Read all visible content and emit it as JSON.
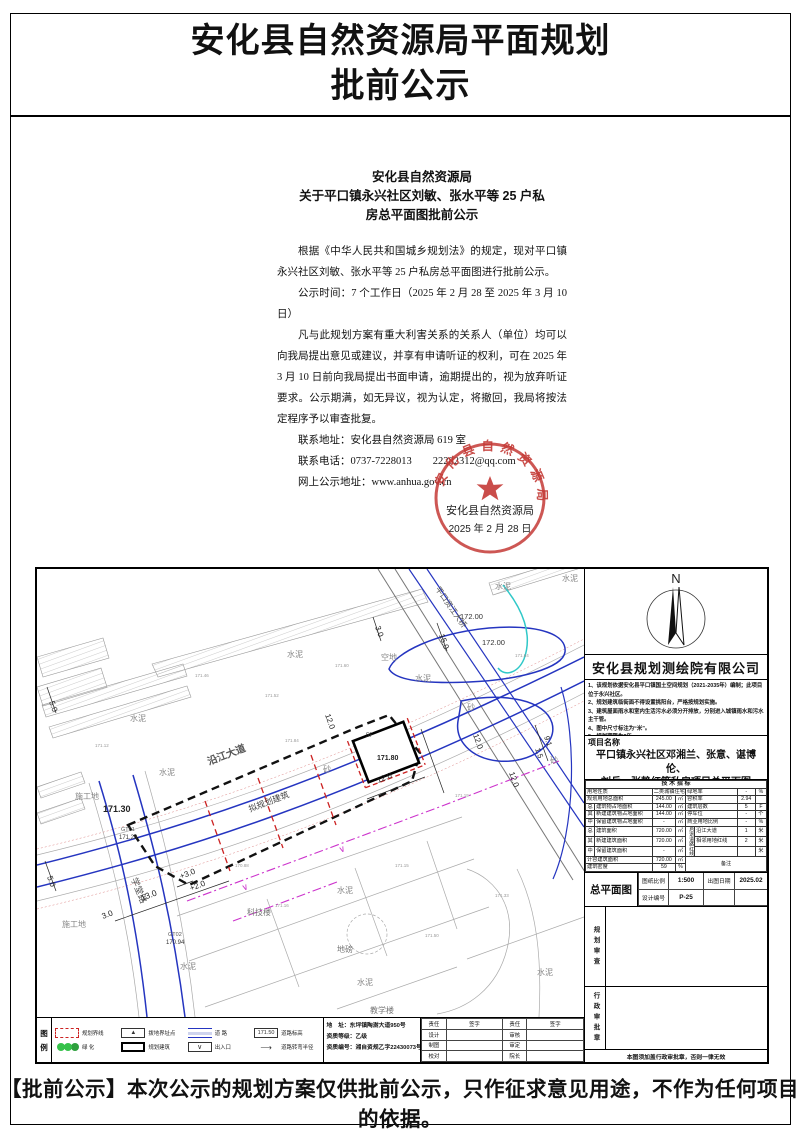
{
  "page": {
    "title1": "安化县自然资源局平面规划",
    "title2": "批前公示",
    "footer": "【批前公示】本次公示的规划方案仅供批前公示，只作征求意见用途，不作为任何项目的依据。"
  },
  "notice": {
    "h1": "安化县自然资源局",
    "h2": "关于平口镇永兴社区刘敏、张水平等 25 户私",
    "h3": "房总平面图批前公示",
    "p1": "根据《中华人民共和国城乡规划法》的规定，现对平口镇永兴社区刘敏、张水平等 25 户私房总平面图进行批前公示。",
    "p2": "公示时间：7 个工作日（2025 年 2 月 28 至 2025 年 3 月 10 日）",
    "p3": "凡与此规划方案有重大利害关系的关系人（单位）均可以向我局提出意见或建议，并享有申请听证的权利，可在 2025 年 3 月 10 日前向我局提出书面申请，逾期提出的，视为放弃听证要求。公示期满，如无异议，视为认定，将撤回，我局将按法定程序予以审查批复。",
    "addr": "联系地址：安化县自然资源局 619 室",
    "phone": "联系电话：0737-7228013　　22282312@qq.com",
    "web": "网上公示地址：www.anhua.gov.cn",
    "seal": {
      "ring": "安化县自然资源局",
      "org": "安化县自然资源局",
      "date": "2025 年 2 月 28 日",
      "color": "#c43a36"
    }
  },
  "panel": {
    "north": "N",
    "company": "安化县规划测绘院有限公司",
    "notes": [
      "1、该规划依据安化县平口镇国土空间规划（2021-2035年）编制；此项目位于永兴社区。",
      "2、规划建筑临街面不得设置挑阳台，严格按规划实施。",
      "3、建筑屋面雨水和室内生活污水必须分开排放，分别进入城镇雨水和污水主干管。",
      "4、图中尺寸标注为“米”。",
      "5、规划期限为2年。"
    ],
    "project_label": "项目名称",
    "project1": "平口镇永兴社区邓湘兰、张意、谌博伦、",
    "project2": "刘兵、张静红等私房项目总平面图",
    "tech": {
      "rows": [
        [
          {
            "t": "技 术 指 标",
            "cs": 8,
            "cl": "hd"
          }
        ],
        [
          {
            "t": "用地性质",
            "cs": 2,
            "cl": "lb"
          },
          {
            "t": "二类城镇住宅用地",
            "cs": 2,
            "cl": "ct"
          },
          {
            "t": "绿地率",
            "cs": 2,
            "cl": "lb"
          },
          {
            "t": "-",
            "cl": "ct"
          },
          {
            "t": "%",
            "cl": "ct"
          }
        ],
        [
          {
            "t": "规划用地总面积",
            "cs": 2,
            "cl": "lb"
          },
          {
            "t": "245.00",
            "cl": "ct"
          },
          {
            "t": "㎡",
            "cl": "ct"
          },
          {
            "t": "容积率",
            "cs": 2,
            "cl": "lb"
          },
          {
            "t": "2.94",
            "cl": "ct"
          },
          {
            "t": "",
            "cl": "ct"
          }
        ],
        [
          {
            "t": "总",
            "cl": "g"
          },
          {
            "t": "建筑物占地面积",
            "cl": "lb"
          },
          {
            "t": "144.00",
            "cl": "ct"
          },
          {
            "t": "㎡",
            "cl": "ct"
          },
          {
            "t": "建筑层数",
            "cs": 2,
            "cl": "lb"
          },
          {
            "t": "5",
            "cl": "ct"
          },
          {
            "t": "F",
            "cl": "ct"
          }
        ],
        [
          {
            "t": "其",
            "cl": "g"
          },
          {
            "t": "新建建筑物占地面积",
            "cl": "lb"
          },
          {
            "t": "144.00",
            "cl": "ct"
          },
          {
            "t": "㎡",
            "cl": "ct"
          },
          {
            "t": "停车位",
            "cs": 2,
            "cl": "lb"
          },
          {
            "t": "-",
            "cl": "ct"
          },
          {
            "t": "个",
            "cl": "ct"
          }
        ],
        [
          {
            "t": "中",
            "cl": "g"
          },
          {
            "t": "保留建筑物占地面积",
            "cl": "lb"
          },
          {
            "t": "-",
            "cl": "ct"
          },
          {
            "t": "㎡",
            "cl": "ct"
          },
          {
            "t": "商业用地比例",
            "cs": 2,
            "cl": "lb"
          },
          {
            "t": "-",
            "cl": "ct"
          },
          {
            "t": "%",
            "cl": "ct"
          }
        ],
        [
          {
            "t": "总",
            "cl": "g"
          },
          {
            "t": "建筑面积",
            "cl": "lb"
          },
          {
            "t": "720.00",
            "cl": "ct"
          },
          {
            "t": "㎡",
            "cl": "ct"
          },
          {
            "t": "后退道路红线",
            "rs": 3,
            "cl": "vert"
          },
          {
            "t": "沿江大道",
            "cl": "lb"
          },
          {
            "t": "1",
            "cl": "ct"
          },
          {
            "t": "米",
            "cl": "ct"
          }
        ],
        [
          {
            "t": "其",
            "cl": "g"
          },
          {
            "t": "新建建筑面积",
            "cl": "lb"
          },
          {
            "t": "720.00",
            "cl": "ct"
          },
          {
            "t": "㎡",
            "cl": "ct"
          },
          {
            "t": "相邻用地红线",
            "cl": "lb"
          },
          {
            "t": "2",
            "cl": "ct"
          },
          {
            "t": "米",
            "cl": "ct"
          }
        ],
        [
          {
            "t": "中",
            "cl": "g"
          },
          {
            "t": "保留建筑面积",
            "cl": "lb"
          },
          {
            "t": "-",
            "cl": "ct"
          },
          {
            "t": "㎡",
            "cl": "ct"
          },
          {
            "t": "",
            "cl": "lb"
          },
          {
            "t": "",
            "cl": "ct"
          },
          {
            "t": "米",
            "cl": "ct"
          }
        ],
        [
          {
            "t": "计容建筑面积",
            "cs": 2,
            "cl": "lb"
          },
          {
            "t": "720.00",
            "cl": "ct"
          },
          {
            "t": "㎡",
            "cl": "ct"
          },
          {
            "t": "备注",
            "cs": 4,
            "rs": 2,
            "cl": "ct"
          }
        ],
        [
          {
            "t": "建筑密度",
            "cs": 2,
            "cl": "lb"
          },
          {
            "t": "59",
            "cl": "ct"
          },
          {
            "t": "%",
            "cl": "ct"
          }
        ]
      ]
    },
    "drawing_title": "总平面图",
    "scale_label": "图纸比例",
    "scale_value": "1:500",
    "date_label": "出图日期",
    "date_value": "2025.02",
    "no_label": "设计编号",
    "no_value": "P-25",
    "review": "规划审查",
    "approval": "行政审批章",
    "note": "本图须加盖行政审批章，否则一律无效"
  },
  "legend": {
    "t1": "图",
    "t2": "例",
    "items": [
      {
        "symbol": "boundary",
        "label": "规划界线"
      },
      {
        "symbol": "marker",
        "glyph": "▲",
        "label": "拨地界址点"
      },
      {
        "symbol": "road",
        "label": "道  路"
      },
      {
        "symbol": "elev",
        "symbol_text": "171.50",
        "label": "道路标高"
      },
      {
        "symbol": "green",
        "label": "绿  化"
      },
      {
        "symbol": "building",
        "label": "规划建筑"
      },
      {
        "symbol": "entrance",
        "glyph": "∨",
        "label": "出入口"
      },
      {
        "symbol": "radius",
        "glyph": "⟶",
        "label": "道路转弯半径"
      }
    ],
    "address": "地　址：东坪镇陶澍大道950号",
    "grade": "资质等级：乙级",
    "cert": "资质编号：湘自资规乙字22430073号",
    "sign": {
      "headers": [
        "责任",
        "签字",
        "责任",
        "签字"
      ],
      "rows": [
        [
          "设计",
          "",
          "审核",
          ""
        ],
        [
          "制图",
          "",
          "审定",
          ""
        ],
        [
          "校对",
          "",
          "院长",
          ""
        ]
      ]
    }
  },
  "map": {
    "labels": [
      {
        "t": "水泥",
        "x": 250,
        "y": 88,
        "c": "#888"
      },
      {
        "t": "水泥",
        "x": 93,
        "y": 152,
        "c": "#888"
      },
      {
        "t": "水泥",
        "x": 122,
        "y": 206,
        "c": "#888"
      },
      {
        "t": "水泥",
        "x": 378,
        "y": 112,
        "c": "#888"
      },
      {
        "t": "水泥",
        "x": 458,
        "y": 20,
        "c": "#888"
      },
      {
        "t": "水泥",
        "x": 525,
        "y": 12,
        "c": "#888"
      },
      {
        "t": "水泥",
        "x": 300,
        "y": 324,
        "c": "#888"
      },
      {
        "t": "水泥",
        "x": 320,
        "y": 416,
        "c": "#888"
      },
      {
        "t": "水泥",
        "x": 143,
        "y": 400,
        "c": "#888"
      },
      {
        "t": "水泥",
        "x": 500,
        "y": 406,
        "c": "#888"
      },
      {
        "t": "砂",
        "x": 430,
        "y": 141,
        "c": "#888"
      },
      {
        "t": "砂",
        "x": 513,
        "y": 194,
        "c": "#888"
      },
      {
        "t": "砂",
        "x": 286,
        "y": 203,
        "c": "#888"
      },
      {
        "t": "空地",
        "x": 344,
        "y": 91,
        "c": "#888"
      },
      {
        "t": "施工地",
        "x": 38,
        "y": 230,
        "c": "#888"
      },
      {
        "t": "施工地",
        "x": 25,
        "y": 358,
        "c": "#888"
      },
      {
        "t": "科技楼",
        "x": 210,
        "y": 346,
        "c": "#777"
      },
      {
        "t": "教学楼",
        "x": 333,
        "y": 444,
        "c": "#777"
      },
      {
        "t": "地磅",
        "x": 300,
        "y": 383,
        "c": "#777"
      },
      {
        "t": "拟规划建筑",
        "x": 213,
        "y": 243,
        "r": -21,
        "s": 8.5,
        "c": "#444"
      },
      {
        "t": "沿江大道",
        "x": 172,
        "y": 196,
        "r": -21,
        "s": 10,
        "c": "#555",
        "b": 1
      },
      {
        "t": "平口资江大桥",
        "x": 398,
        "y": 20,
        "r": 55,
        "s": 8,
        "c": "#555"
      },
      {
        "t": "学堂路",
        "x": 94,
        "y": 310,
        "r": 68,
        "s": 9,
        "c": "#555"
      },
      {
        "t": "171.30",
        "x": 66,
        "y": 243,
        "s": 9,
        "c": "#222",
        "b": 1
      },
      {
        "t": "172.00",
        "x": 423,
        "y": 50,
        "s": 7.5,
        "c": "#333"
      },
      {
        "t": "172.00",
        "x": 445,
        "y": 76,
        "s": 7.5,
        "c": "#333"
      },
      {
        "t": "GT02",
        "x": 131,
        "y": 367,
        "s": 5.5,
        "c": "#555"
      },
      {
        "t": "170.94",
        "x": 129,
        "y": 375,
        "s": 6,
        "c": "#333"
      },
      {
        "t": "GT01",
        "x": 84,
        "y": 262,
        "s": 5.5,
        "c": "#555"
      },
      {
        "t": "171.28",
        "x": 82,
        "y": 270,
        "s": 6,
        "c": "#333"
      },
      {
        "t": "5F",
        "x": 329,
        "y": 168,
        "s": 6,
        "c": "#333"
      },
      {
        "t": "171.80",
        "x": 340,
        "y": 191,
        "s": 7,
        "c": "#222",
        "b": 1
      },
      {
        "t": "12.0",
        "x": 288,
        "y": 146,
        "r": 70,
        "s": 8,
        "c": "#222"
      },
      {
        "t": "12.0",
        "x": 436,
        "y": 166,
        "r": 70,
        "s": 8,
        "c": "#222"
      },
      {
        "t": "12.0",
        "x": 341,
        "y": 214,
        "r": -21,
        "s": 8,
        "c": "#222"
      },
      {
        "t": "12.0",
        "x": 472,
        "y": 204,
        "r": 70,
        "s": 8,
        "c": "#222"
      },
      {
        "t": "3.0",
        "x": 338,
        "y": 58,
        "r": 70,
        "s": 8,
        "c": "#222"
      },
      {
        "t": "3.0",
        "x": 66,
        "y": 350,
        "r": -21,
        "s": 8,
        "c": "#222"
      },
      {
        "t": "13.0",
        "x": 105,
        "y": 332,
        "r": -21,
        "s": 8.5,
        "c": "#222"
      },
      {
        "t": "15.0",
        "x": 402,
        "y": 66,
        "r": 70,
        "s": 8,
        "c": "#222"
      },
      {
        "t": "9.1",
        "x": 507,
        "y": 168,
        "r": 70,
        "s": 7.5,
        "c": "#222"
      },
      {
        "t": "1.5",
        "x": 498,
        "y": 180,
        "r": 70,
        "s": 7.5,
        "c": "#222"
      },
      {
        "t": "+3.0",
        "x": 144,
        "y": 310,
        "r": -21,
        "s": 8,
        "c": "#222"
      },
      {
        "t": "+2.0",
        "x": 154,
        "y": 322,
        "r": -21,
        "s": 8,
        "c": "#222"
      },
      {
        "t": "5.0",
        "x": 10,
        "y": 308,
        "r": 70,
        "s": 8,
        "c": "#222"
      },
      {
        "t": "5.0",
        "x": 12,
        "y": 133,
        "r": 70,
        "s": 8,
        "c": "#222"
      },
      {
        "t": "∨",
        "x": 206,
        "y": 322,
        "r": -21,
        "s": 9,
        "c": "#cc33cc"
      },
      {
        "t": "∨",
        "x": 303,
        "y": 284,
        "r": -21,
        "s": 9,
        "c": "#cc33cc"
      },
      {
        "t": "171.46",
        "x": 158,
        "y": 108,
        "s": 4.5,
        "c": "#999"
      },
      {
        "t": "171.52",
        "x": 228,
        "y": 128,
        "s": 4.5,
        "c": "#999"
      },
      {
        "t": "171.60",
        "x": 298,
        "y": 98,
        "s": 4.5,
        "c": "#999"
      },
      {
        "t": "171.84",
        "x": 248,
        "y": 173,
        "s": 4.5,
        "c": "#999"
      },
      {
        "t": "171.19",
        "x": 418,
        "y": 228,
        "s": 4.5,
        "c": "#999"
      },
      {
        "t": "171.15",
        "x": 358,
        "y": 298,
        "s": 4.5,
        "c": "#999"
      },
      {
        "t": "171.33",
        "x": 458,
        "y": 328,
        "s": 4.5,
        "c": "#999"
      },
      {
        "t": "170.88",
        "x": 198,
        "y": 298,
        "s": 4.5,
        "c": "#999"
      },
      {
        "t": "171.12",
        "x": 58,
        "y": 178,
        "s": 4.5,
        "c": "#999"
      },
      {
        "t": "171.64",
        "x": 478,
        "y": 88,
        "s": 4.5,
        "c": "#999"
      },
      {
        "t": "171.16",
        "x": 238,
        "y": 338,
        "s": 4.5,
        "c": "#999"
      },
      {
        "t": "171.50",
        "x": 388,
        "y": 368,
        "s": 4.5,
        "c": "#999"
      }
    ]
  }
}
